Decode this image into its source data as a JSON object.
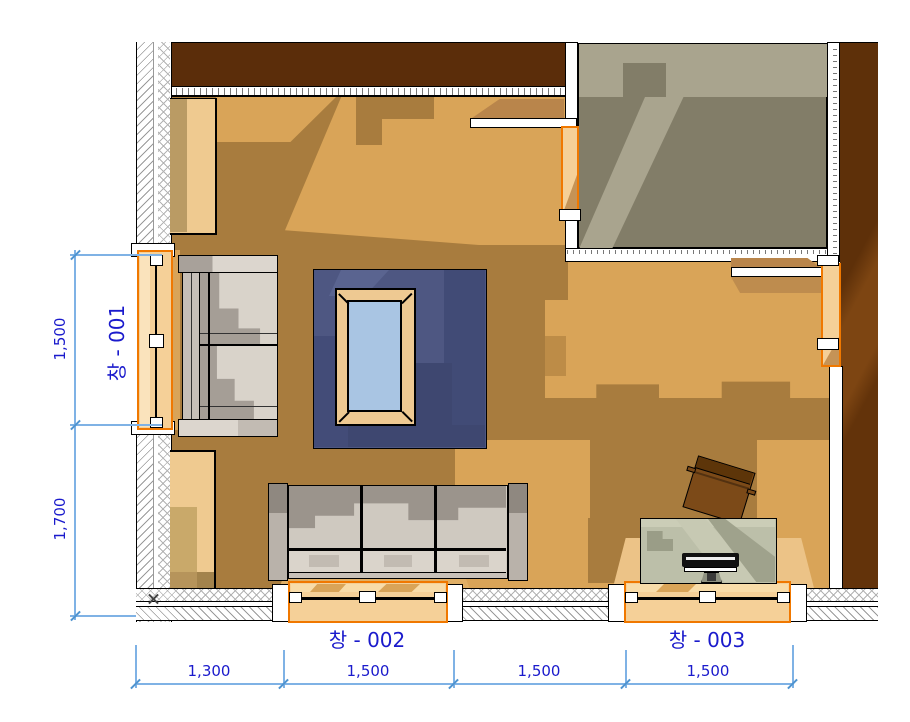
{
  "plan": {
    "windows": [
      {
        "name": "window-001",
        "label": "창 - 001"
      },
      {
        "name": "window-002",
        "label": "창 - 002"
      },
      {
        "name": "window-003",
        "label": "창 - 003"
      }
    ],
    "dimensions": {
      "left": [
        "1,500",
        "1,700"
      ],
      "bottom": [
        "1,300",
        "1,500",
        "1,500",
        "1,500"
      ]
    },
    "colors": {
      "dimension_line": "#7FB2E5",
      "annotation_text": "#1A1ACC",
      "wall_fill_dark": "#5B2D0A",
      "floor_light": "#D9A458",
      "floor_shadow": "#A87C3E",
      "opening_highlight": "#F07800",
      "opening_fill": "#F5D098",
      "rug": "#4E5782",
      "table_glass": "#A9C5E3",
      "adjacent_room_floor": "#827D68"
    },
    "furniture": [
      "loveseat",
      "three-seat-sofa",
      "area-rug",
      "coffee-table",
      "desk",
      "desk-chair",
      "monitor",
      "cabinet-upper",
      "cabinet-lower"
    ]
  }
}
